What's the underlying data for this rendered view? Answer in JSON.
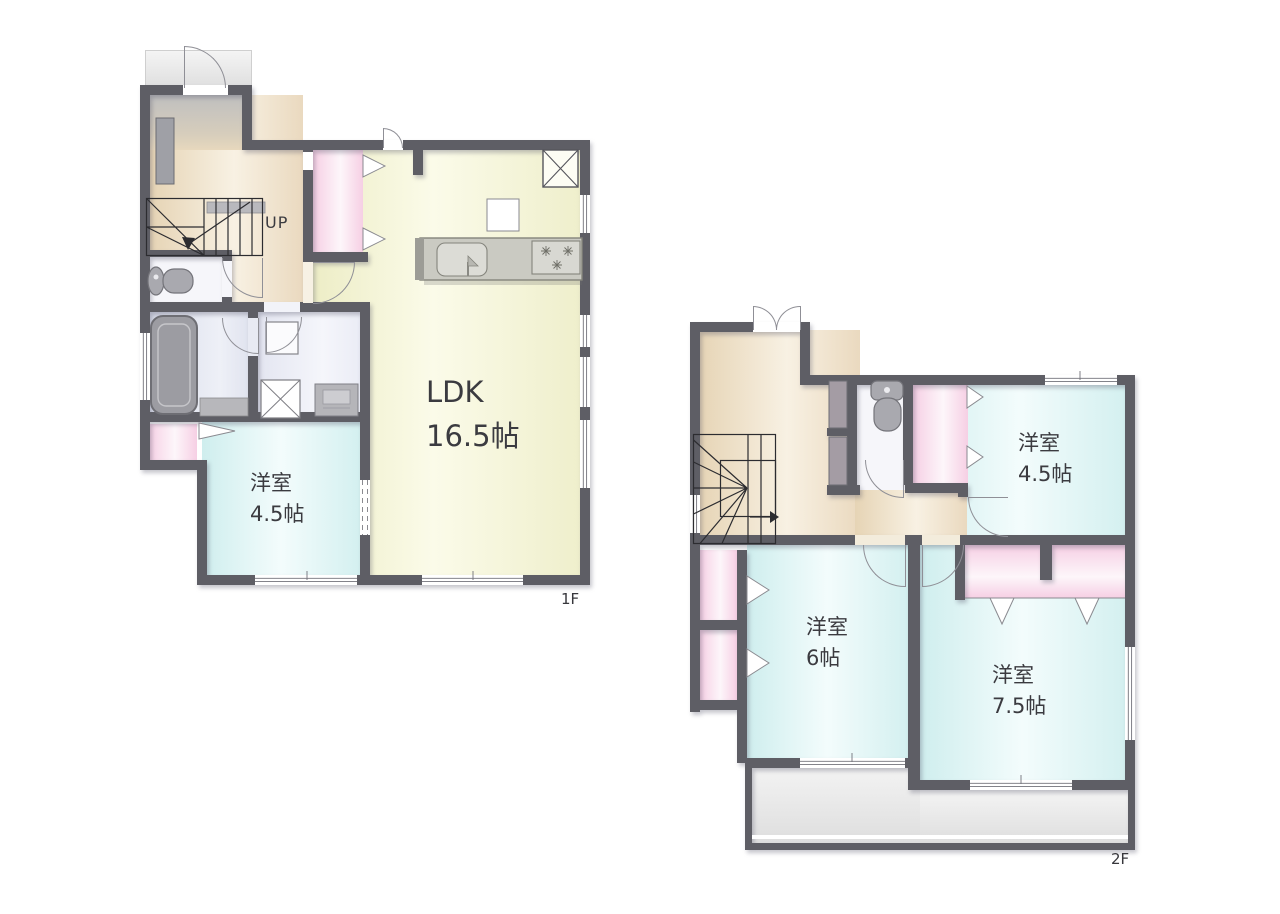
{
  "plan": {
    "colors": {
      "wall": "#5e5e65",
      "ldk_floor": "#f6f6da",
      "bedroom_floor": "#daf1f1",
      "hall_floor": "#ecdcc0",
      "closet": "#f6cfe4",
      "balcony": "#e4e4e4"
    },
    "floor1": {
      "tag": "1F",
      "stairs_label": "UP",
      "ldk": {
        "name": "LDK",
        "size": "16.5帖"
      },
      "bedroom": {
        "name": "洋室",
        "size": "4.5帖"
      }
    },
    "floor2": {
      "tag": "2F",
      "bedroom_a": {
        "name": "洋室",
        "size": "4.5帖"
      },
      "bedroom_b": {
        "name": "洋室",
        "size": "6帖"
      },
      "bedroom_c": {
        "name": "洋室",
        "size": "7.5帖"
      }
    }
  }
}
